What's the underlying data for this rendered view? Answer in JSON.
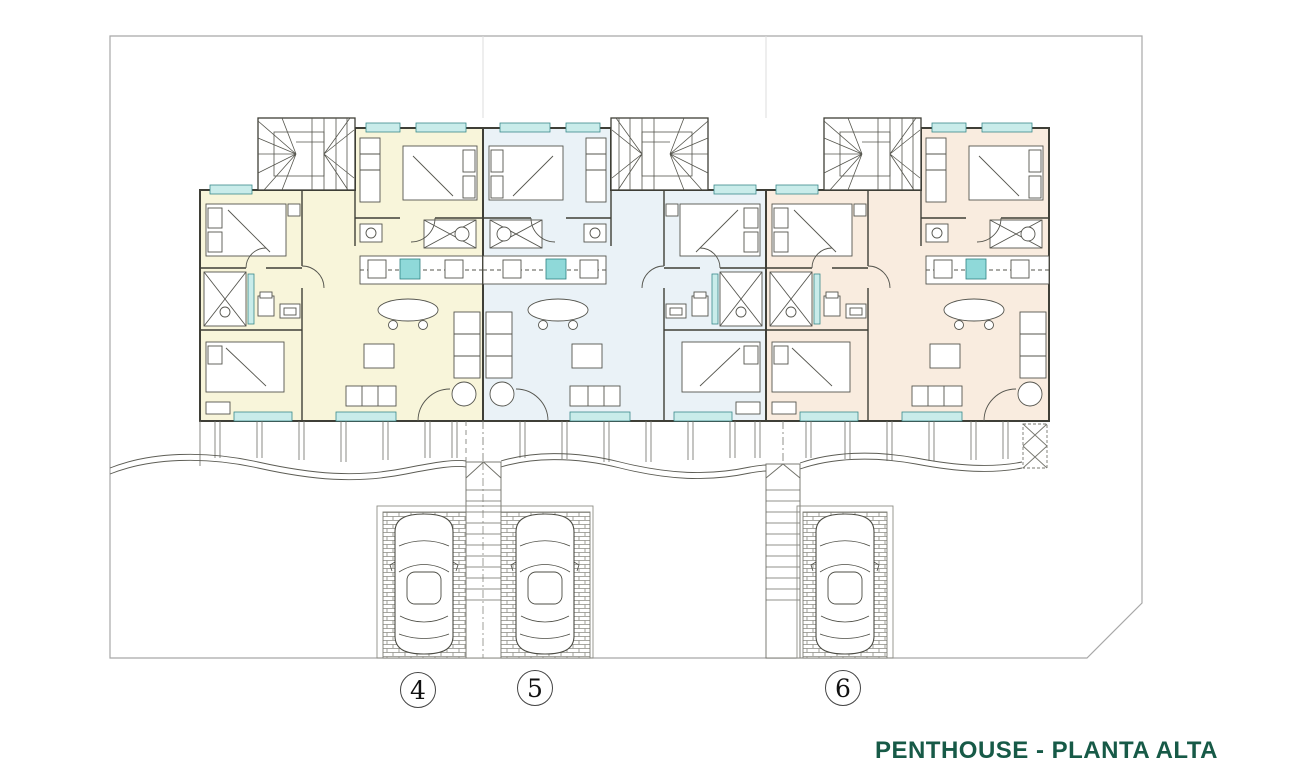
{
  "drawing": {
    "title": {
      "text": "PENTHOUSE - PLANTA ALTA",
      "color": "#175a47"
    },
    "units": [
      {
        "label": "4",
        "fill": "#f8f5da"
      },
      {
        "label": "5",
        "fill": "#eaf2f7"
      },
      {
        "label": "6",
        "fill": "#f9ecdf"
      }
    ],
    "window_color": "#c9ecea",
    "hob_color": "#8fd9d9"
  }
}
